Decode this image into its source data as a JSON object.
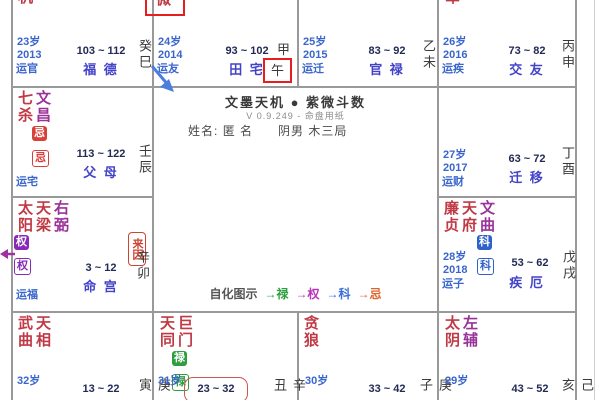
{
  "app": {
    "title": "文墨天机 ● 紫微斗数",
    "subtitle": "V 0.9.249 - 命盘用纸",
    "name_label": "姓名:",
    "name_value": "匿 名",
    "profile": "阴男 木三局",
    "legend": {
      "label": "自化图示",
      "items": [
        {
          "text": "→禄",
          "color": "#2f9e3f"
        },
        {
          "text": "→权",
          "color": "#b835b8"
        },
        {
          "text": "→科",
          "color": "#3a6fd8"
        },
        {
          "text": "→忌",
          "color": "#e0662e"
        }
      ]
    }
  },
  "palaces": {
    "si": {
      "stars": [
        "天机"
      ],
      "age": "23岁",
      "year": "2013",
      "yun": "运官",
      "range": "103 ~ 112",
      "palace": "福 德",
      "stem": "癸",
      "branch": "巳"
    },
    "wu": {
      "stars": [
        "紫微"
      ],
      "age": "24岁",
      "year": "2014",
      "yun": "运友",
      "range": "93 ~ 102",
      "palace": "田 宅",
      "stem": "甲",
      "branch": "午"
    },
    "wei": {
      "age": "25岁",
      "year": "2015",
      "yun": "运迁",
      "range": "83 ~ 92",
      "palace": "官 禄",
      "stem": "乙",
      "branch": "未"
    },
    "shen": {
      "stars": [
        "破军"
      ],
      "age": "26岁",
      "year": "2016",
      "yun": "运疾",
      "range": "73 ~ 82",
      "palace": "交 友",
      "stem": "丙",
      "branch": "申"
    },
    "chen": {
      "stars": [
        "七杀",
        "文昌"
      ],
      "badges": [
        "忌",
        "忌"
      ],
      "yun": "运宅",
      "range": "113 ~ 122",
      "palace": "父 母",
      "stem": "壬",
      "branch": "辰"
    },
    "you": {
      "age": "27岁",
      "year": "2017",
      "yun": "运财",
      "range": "63 ~ 72",
      "palace": "迁 移",
      "stem": "丁",
      "branch": "酉"
    },
    "mao": {
      "stars": [
        "太阳",
        "天梁",
        "右弼"
      ],
      "badges": [
        "权",
        "权"
      ],
      "laiyin": "来因",
      "yun": "运福",
      "range": "3 ~ 12",
      "palace": "命 宫",
      "stem": "辛",
      "branch": "卯"
    },
    "xu": {
      "stars": [
        "廉贞",
        "天府",
        "文曲"
      ],
      "badges": [
        "科",
        "科"
      ],
      "age": "28岁",
      "year": "2018",
      "yun": "运子",
      "range": "53 ~ 62",
      "palace": "疾 厄",
      "stem": "戊",
      "branch": "戌"
    },
    "yin": {
      "stars": [
        "武曲",
        "天相"
      ],
      "age": "32岁",
      "range": "13 ~ 22",
      "stem": "庚",
      "branch": "寅"
    },
    "chou": {
      "stars": [
        "天同",
        "巨门"
      ],
      "badges": [
        "禄",
        "禄"
      ],
      "age": "31岁",
      "range": "23 ~ 32",
      "stem": "辛",
      "branch": "丑"
    },
    "zi": {
      "stars": [
        "贪狼"
      ],
      "age": "30岁",
      "range": "33 ~ 42",
      "stem": "庚",
      "branch": "子"
    },
    "hai": {
      "stars": [
        "太阴",
        "左辅"
      ],
      "age": "29岁",
      "range": "43 ~ 52",
      "stem": "己",
      "branch": "亥"
    }
  },
  "colors": {
    "main_star": "#c03a45",
    "aux_star": "#993399",
    "label_blue": "#3a66cc",
    "palace_blue": "#4343c8",
    "range_dark": "#222a55",
    "stem_dark": "#3a3a3a",
    "highlight_red": "#e81e1e",
    "lu_green": "#2f9e3f",
    "quan_purple": "#8a28b8",
    "ke_blue": "#2f62c8",
    "ji_red": "#d8403a",
    "laiyin_red": "#cc4433",
    "blue_arrow": "#4a7fe0",
    "purple_arrow": "#a030a0",
    "grid": "#999999"
  }
}
